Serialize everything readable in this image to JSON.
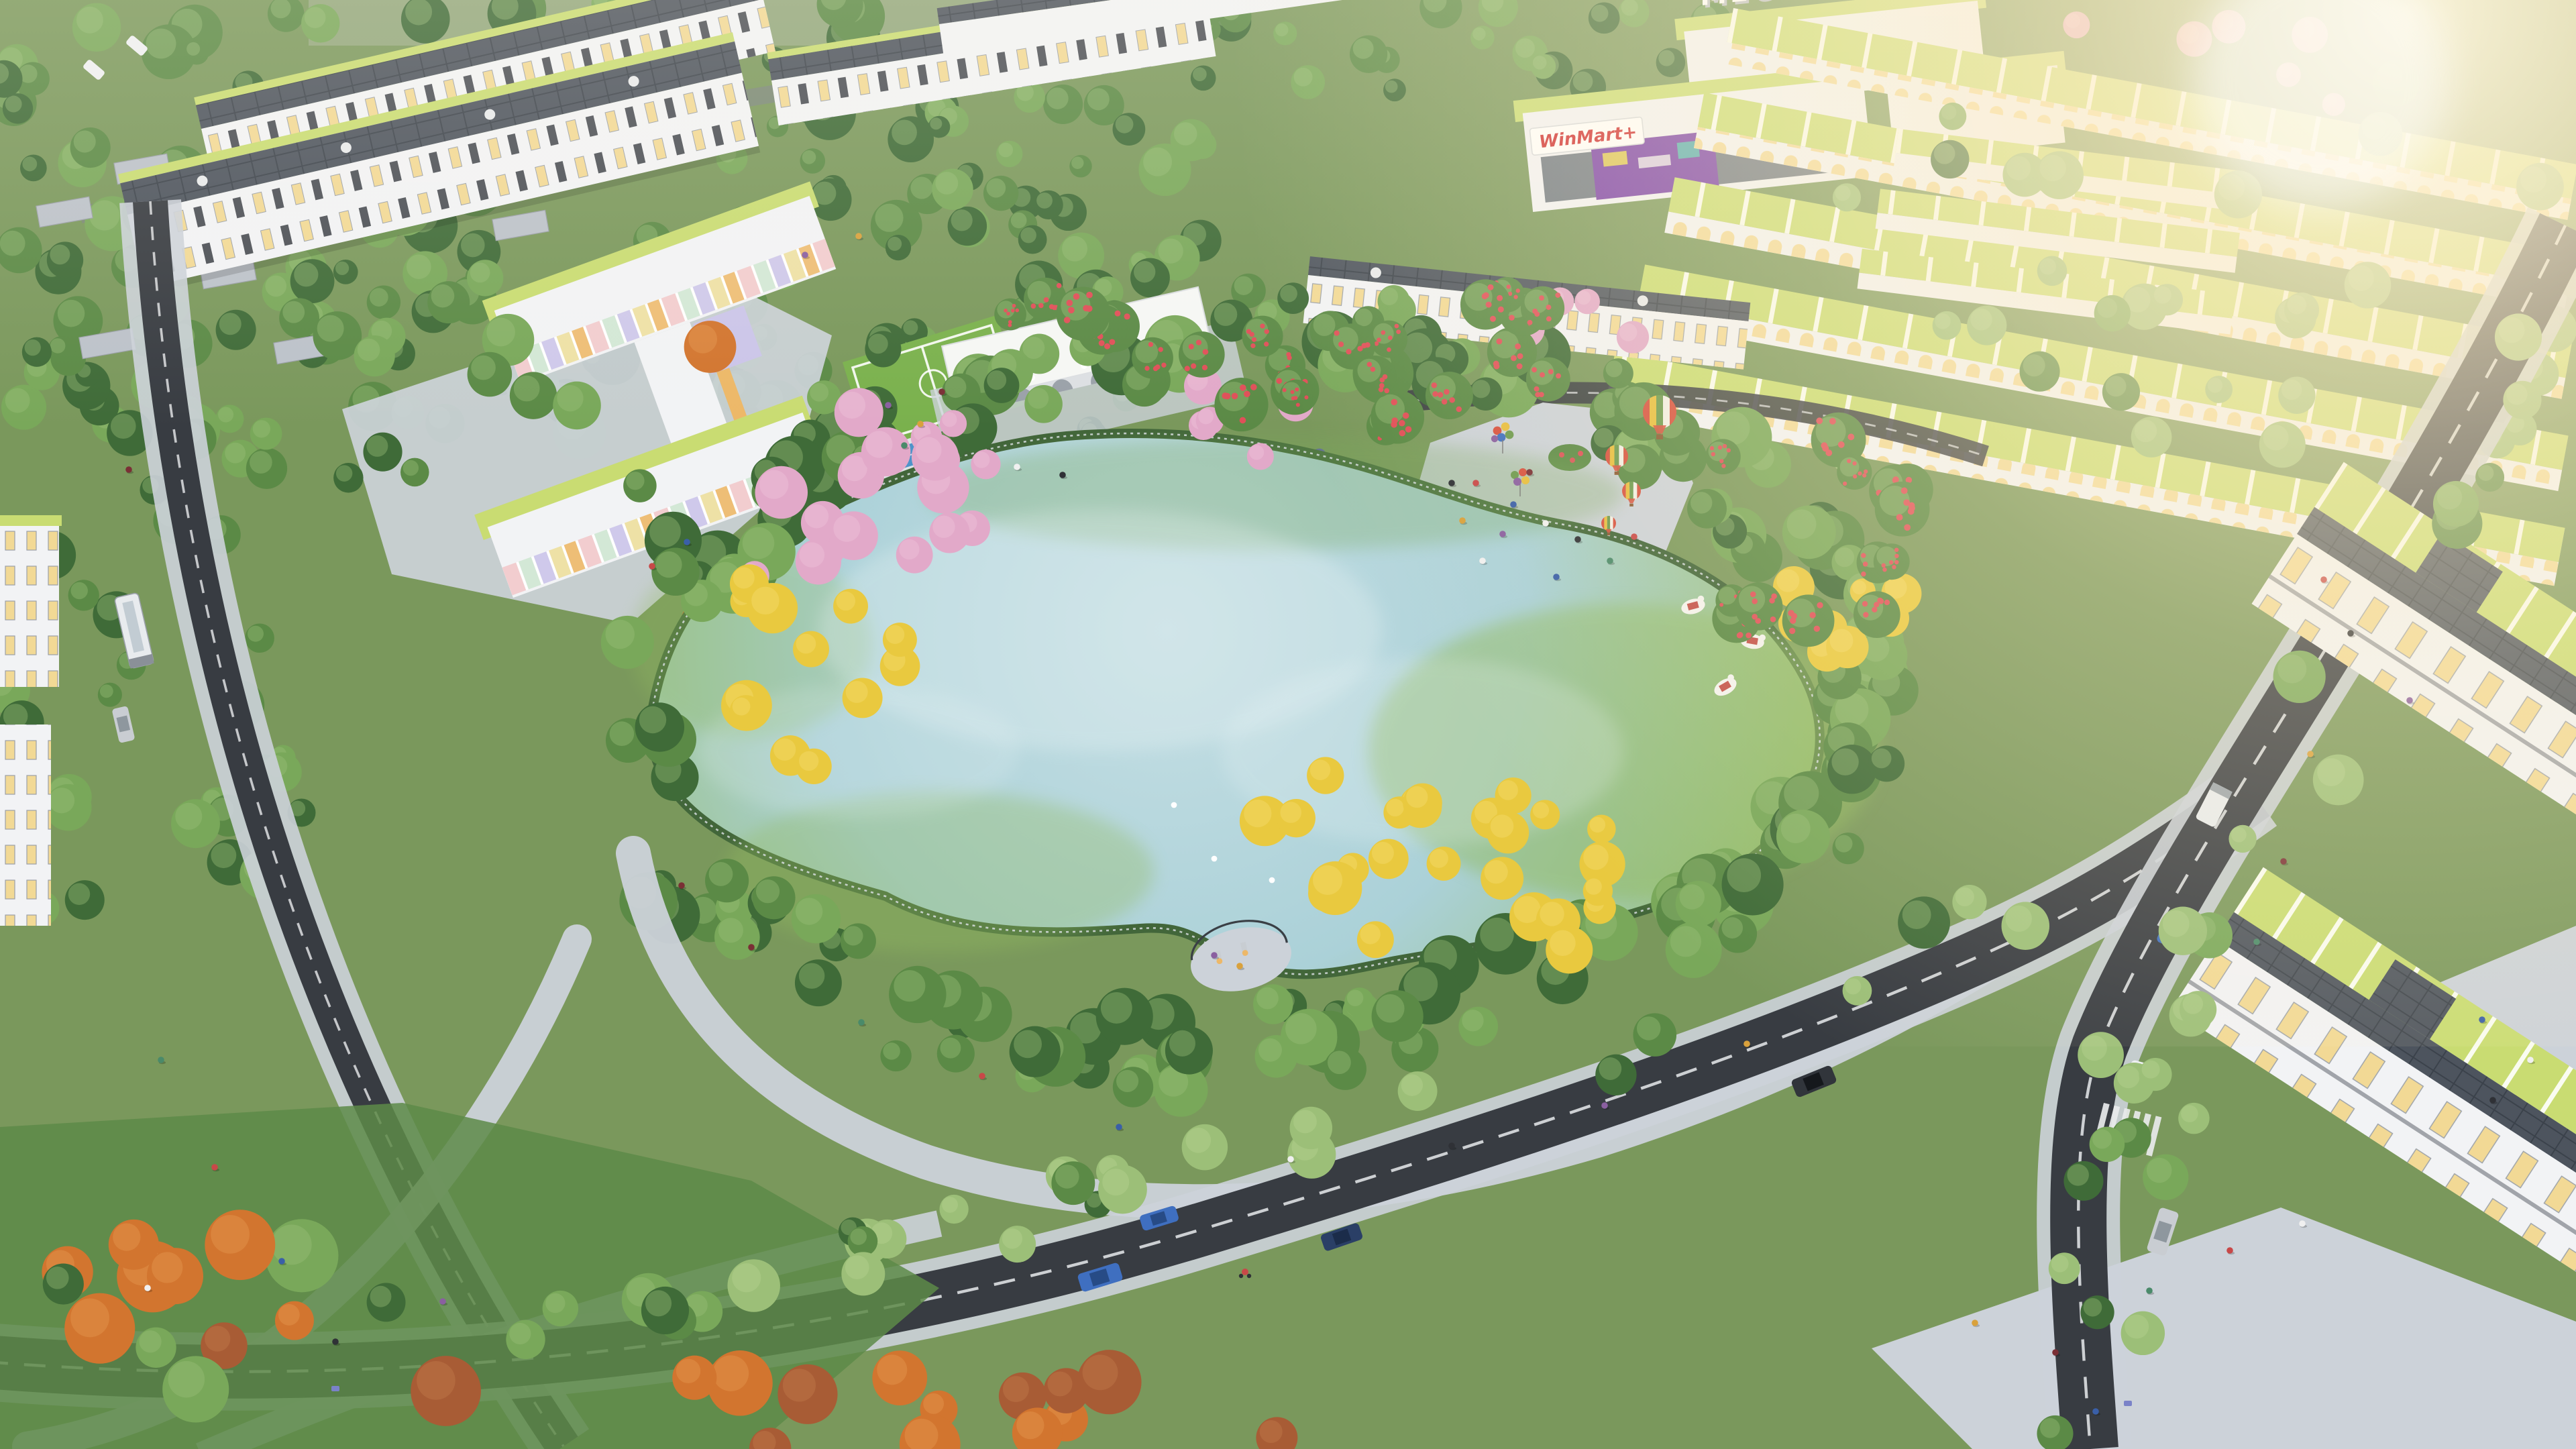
{
  "meta": {
    "title": "Aerial rendering of a lakeside residential park at golden hour",
    "media_type": "3D architectural visualization, bird's-eye view"
  },
  "signs": {
    "mall_roof_sign": "MEGAMALL",
    "supermarket_sign": "WinMart+"
  },
  "scene": {
    "description": "Golden-hour aerial render of a master-planned neighborhood: rows of white townhouses with lime-green and slate roofs surround a kidney-shaped lake park ringed by flowering trees, a paved promenade, a pastel kindergarten, a mini football pitch, a pool, a white arched pavilion, festival hot-air balloon props and swan pedal boats.",
    "time_of_day": "late afternoon, sun flaring from the top-right corner",
    "counts": {
      "hot_air_balloon_props": 4,
      "balloon_bouquets": 2,
      "swan_pedal_boats": 3,
      "swans_on_lake": 4,
      "cars_visible": 10,
      "buses_visible": 1,
      "cyclists_visible": 1
    }
  },
  "peopleColors": [
    "#c84848",
    "#3a5fa8",
    "#f0f0f0",
    "#2f3136",
    "#8a5fa0",
    "#d9a13c",
    "#7a2f35",
    "#4a8a6a"
  ],
  "colors": {
    "groundGreen": "#7a985c",
    "fieldStrip": "#95a97f",
    "forestDark": "#3f6b38",
    "forestMid": "#5b8a46",
    "forestLight": "#79a85a",
    "treePale": "#9cbf78",
    "treeYellow": "#e9c93f",
    "treeYellowHi": "#f4de74",
    "treePink": "#e2a9c9",
    "treePinkLight": "#f0c6dc",
    "treeOrange": "#d2752f",
    "treeOrangeHi": "#e59a52",
    "treeRust": "#a85c35",
    "treeRustHi": "#c27c4e",
    "flowerRed": "#e04f58",
    "hedgeDark": "#42663a",
    "lakeCenter": "#c6dfe4",
    "lakeMid": "#abd1d8",
    "lakeEdgeGreen": "#93bb60",
    "lakeHighlight": "#eef6f7",
    "pavement": "#c7ccd3",
    "promenade": "#ccd2d9",
    "roadDark": "#383c42",
    "laneMark": "#e8eaec",
    "roofLime": "#c9dc72",
    "roofSlate": "#4d545e",
    "roofSlateDark": "#3b424b",
    "facadeWhite": "#f2f3f5",
    "facadeShade": "#dcdfe3",
    "windowWarm": "#f2d995",
    "windowDark": "#2f343b",
    "pastelPink": "#f2c9cb",
    "pastelMint": "#cfe7d3",
    "pastelLavender": "#cbc4ea",
    "pastelYellow": "#eedf9d",
    "trimOrange": "#edb868",
    "billboardPurple": "#7a3fa8",
    "signRed": "#cf2b2f",
    "poolBlue": "#4e93c9",
    "fieldGreen": "#7ab14d",
    "sunCore": "#fff7df",
    "sunGlow": "#ffeec6",
    "carSilver": "#c9cdd2",
    "carBlue": "#3f6fc0",
    "carNavy": "#2a3f66",
    "carWhite": "#eef0f2",
    "carDark": "#31353b",
    "busWhite": "#e8ebee",
    "balloonRed": "#d7513f",
    "balloonGreen": "#6d9a4f",
    "balloonYellow": "#e7be3f",
    "balloonWhite": "#f1efe6",
    "basketBrown": "#8a5a33",
    "boatWhite": "#f4f3ef",
    "boatRed": "#bf4038"
  }
}
